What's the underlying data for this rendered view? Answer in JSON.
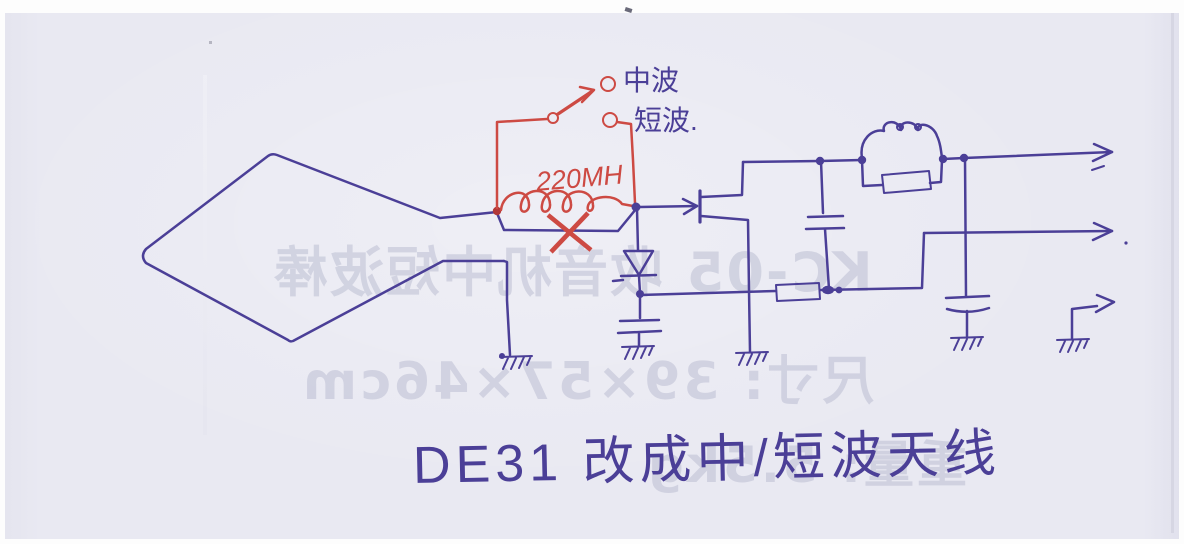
{
  "title": {
    "caption": "DE31 改成中/短波天线"
  },
  "schematic": {
    "switch": {
      "mw_label": "中波",
      "sw_label": "短波."
    },
    "inductor": {
      "value_label": "220MH"
    }
  },
  "bleed_through": {
    "line1": "KC-05 收音机中短波棒",
    "line2": "尺寸: 39×57×46cm",
    "line3": "重量: 5.5kg"
  },
  "colors": {
    "paper": "#e9e9f2",
    "ink_blue": "#4b3f97",
    "ink_red": "#cd4a43",
    "ink_red_dark": "#b23838",
    "bleed_text": "#a8abc4"
  }
}
